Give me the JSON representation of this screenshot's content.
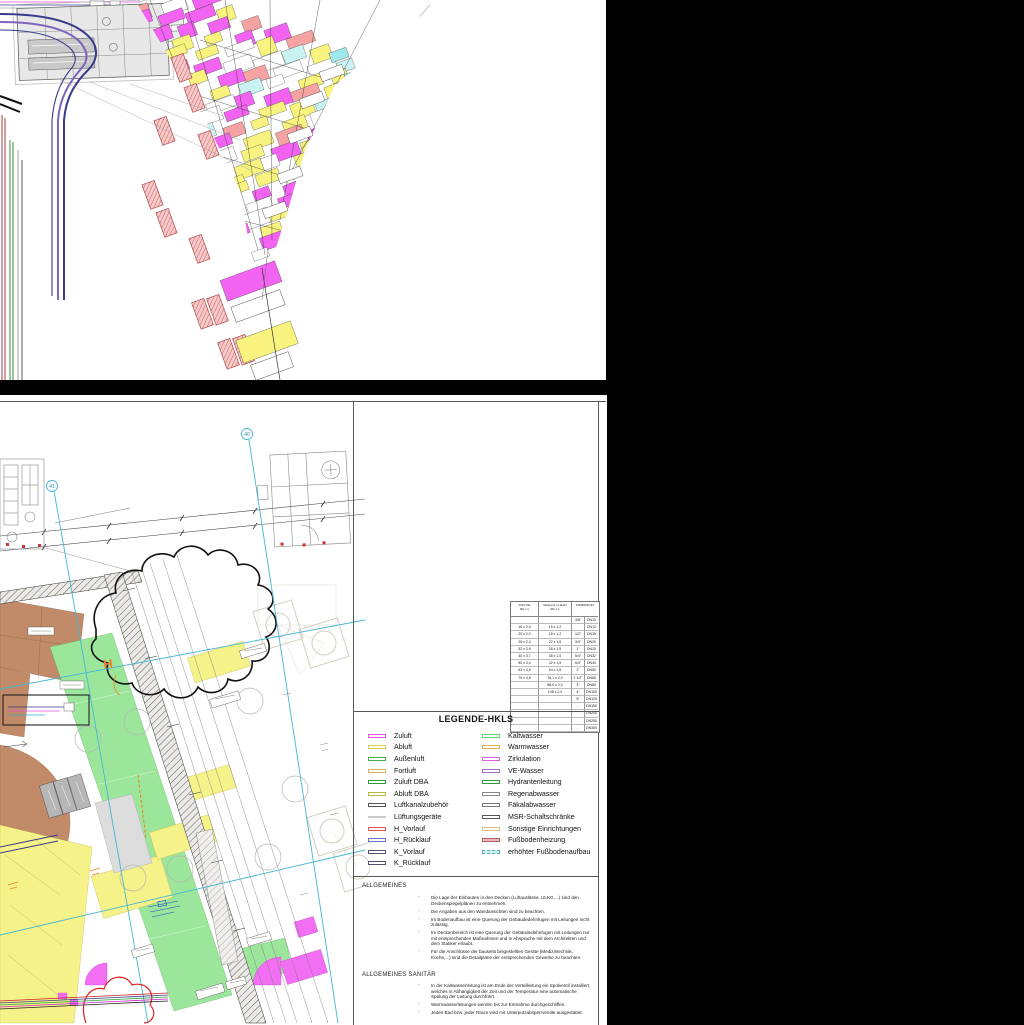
{
  "palette": {
    "duct_magenta": "#f263f2",
    "duct_yellow": "#f7f37e",
    "fitting_salmon": "#f4a2a2",
    "grid_cyan": "#45b7d2",
    "floor_brown": "#c18a68",
    "zone_green": "#9ce69c",
    "annotation_orange": "#f08020",
    "revision_red": "#dd2222"
  },
  "plan": {
    "grid_markers": [
      {
        "label": "41"
      },
      {
        "label": "40"
      }
    ],
    "heating_marker": "H"
  },
  "panel": {
    "dim_table": {
      "headers": [
        [
          "Rohr PE",
          "Øa x s"
        ],
        [
          "Mapress C-Stahl",
          "Øa x s"
        ],
        [
          "DIMENSION",
          ""
        ]
      ],
      "rows": [
        [
          "",
          "",
          "3/8\"",
          "DN10"
        ],
        [
          "16 x 2,0",
          "15 x 1,2",
          "",
          "DN12"
        ],
        [
          "20 x 2,0",
          "18 x 1,2",
          "1/2\"",
          "DN15"
        ],
        [
          "25 x 2,3",
          "22 x 1,5",
          "3/4\"",
          "DN20"
        ],
        [
          "32 x 2,9",
          "28 x 1,5",
          "1\"",
          "DN25"
        ],
        [
          "40 x 3,7",
          "35 x 1,5",
          "5/4\"",
          "DN32"
        ],
        [
          "50 x 3,0",
          "42 x 1,5",
          "6/4\"",
          "DN40"
        ],
        [
          "63 x 4,5",
          "54 x 1,5",
          "2\"",
          "DN50"
        ],
        [
          "75 x 4,5",
          "76,1 x 2,0",
          "2 1/2\"",
          "DN65"
        ],
        [
          "",
          "88,9 x 2,0",
          "3\"",
          "DN80"
        ],
        [
          "",
          "108 x 2,0",
          "4\"",
          "DN100"
        ],
        [
          "",
          "",
          "5\"",
          "DN125"
        ],
        [
          "",
          "",
          "-",
          "DN150"
        ],
        [
          "",
          "",
          "-",
          "DN200"
        ],
        [
          "",
          "",
          "-",
          "DN250"
        ],
        [
          "",
          "",
          "-",
          "DN300"
        ]
      ]
    },
    "legend": {
      "title": "LEGENDE-HKLS",
      "left": [
        {
          "label": "Zuluft",
          "color": "#e950e9",
          "style": "outline"
        },
        {
          "label": "Abluft",
          "color": "#d6d050",
          "style": "outline"
        },
        {
          "label": "Außenluft",
          "color": "#4caf50",
          "style": "outline"
        },
        {
          "label": "Fortluft",
          "color": "#d9b35c",
          "style": "outline"
        },
        {
          "label": "Zuluft DBA",
          "color": "#2e9e3e",
          "style": "outline"
        },
        {
          "label": "Abluft DBA",
          "color": "#b8b832",
          "style": "outline"
        },
        {
          "label": "Luftkanalzubehör",
          "color": "#555555",
          "style": "outline"
        },
        {
          "label": "Lüftungsgeräte",
          "color": "#999999",
          "style": "line"
        },
        {
          "label": "H_Vorlauf",
          "color": "#e05555",
          "style": "outline"
        },
        {
          "label": "H_Rücklauf",
          "color": "#7070c0",
          "style": "outline"
        },
        {
          "label": "K_Vorlauf",
          "color": "#50506e",
          "style": "outline"
        },
        {
          "label": "K_Rücklauf",
          "color": "#50506e",
          "style": "outline"
        }
      ],
      "right": [
        {
          "label": "Kaltwasser",
          "color": "#6dd96d",
          "style": "outline"
        },
        {
          "label": "Warmwasser",
          "color": "#e0b050",
          "style": "outline"
        },
        {
          "label": "Zirkulation",
          "color": "#e060e0",
          "style": "outline"
        },
        {
          "label": "VE-Wasser",
          "color": "#a070d0",
          "style": "outline"
        },
        {
          "label": "Hydrantenleitung",
          "color": "#2f9e3f",
          "style": "outline"
        },
        {
          "label": "Regenabwasser",
          "color": "#888888",
          "style": "outline"
        },
        {
          "label": "Fäkalabwasser",
          "color": "#777777",
          "style": "outline"
        },
        {
          "label": "MSR-Schaltschränke",
          "color": "#555555",
          "style": "outline"
        },
        {
          "label": "Sonstige Einrichtungen",
          "color": "#e0c080",
          "style": "outline"
        },
        {
          "label": "Fußbodenheizung",
          "color": "#b06060",
          "fill": "#eab6b6",
          "style": "filled"
        },
        {
          "label": "erhöhter Fußbodenaufbau",
          "color": "#6aa8b0",
          "fill": "#c9eef2",
          "style": "filled-dashed"
        }
      ]
    },
    "notes": {
      "bullet": "-",
      "general_title": "ALLGEMEINES",
      "general_items": [
        "Die Lage der Einbauten in den Decken (Luftauslässe, ULKG,...) sind den Deckenspiegelplänen zu entnehmen.",
        "Die Angaben aus den Wandansichten sind zu beachten.",
        "Im Bodenaufbau ist eine Querung der Gebäudedehnfugen mit Leitungen nicht zulässig.",
        "Im Deckenbereich ist eine Querung der Gebäudedehnfugen mit Leitungen nur mit entsprechenden Maßnahmen und in Absprache mit dem Architekten und dem Statiker erlaubt.",
        "Für die Anschlüsse der bauseits beigestellten Geräte (Medizintechnik, Küche,...) sind die Detailpläne der entsprechenden Gewerke zu beachten."
      ],
      "sanitary_title": "ALLGEMEINES SANITÄR",
      "sanitary_items": [
        "In der Kaltwasserleitung ist am Ende der Verteilleitung ein Spülventil installiert, welches in Abhängigkeit der Zeit und der Temperatur eine automatische Spülung der Leitung durchführt.",
        "Warmwasserleitungen werden bis zur Entnahme durchgeschliffen.",
        "Jedes Bad bzw. jeder Raum wird mit Unterputzabsperrventile ausgestattet."
      ]
    }
  }
}
